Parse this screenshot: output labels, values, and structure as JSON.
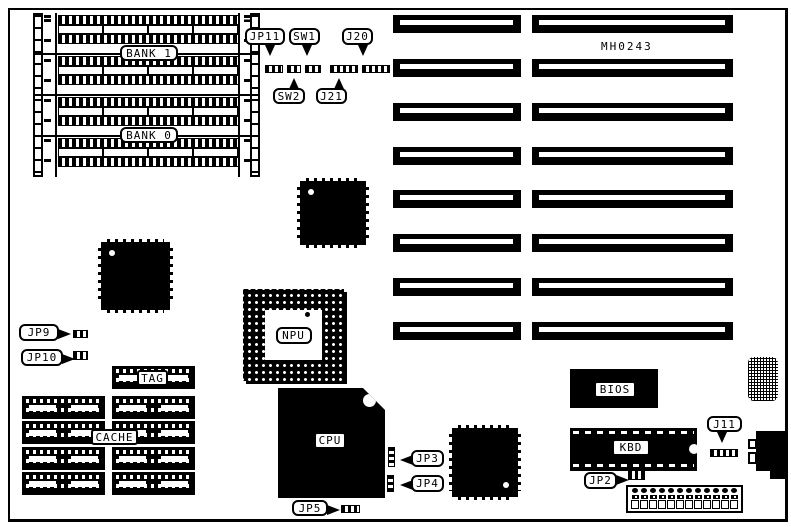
{
  "board": {
    "part_number": "MH0243"
  },
  "labels": {
    "bank1": "BANK 1",
    "bank0": "BANK 0",
    "jp11": "JP11",
    "sw1": "SW1",
    "sw2": "SW2",
    "j20": "J20",
    "j21": "J21",
    "jp9": "JP9",
    "jp10": "JP10",
    "tag": "TAG",
    "cache": "CACHE",
    "npu": "NPU",
    "cpu": "CPU",
    "jp3": "JP3",
    "jp4": "JP4",
    "jp5": "JP5",
    "bios": "BIOS",
    "kbd": "KBD",
    "j11": "J11",
    "jp2": "JP2"
  },
  "counts": {
    "expansion_slot_rows": 8,
    "expansion_slot_columns": 2,
    "simm_sockets": 4,
    "cache_chip_rows": 4,
    "cache_chip_columns": 2,
    "tag_chips": 1,
    "power_connector_pins": 12
  }
}
